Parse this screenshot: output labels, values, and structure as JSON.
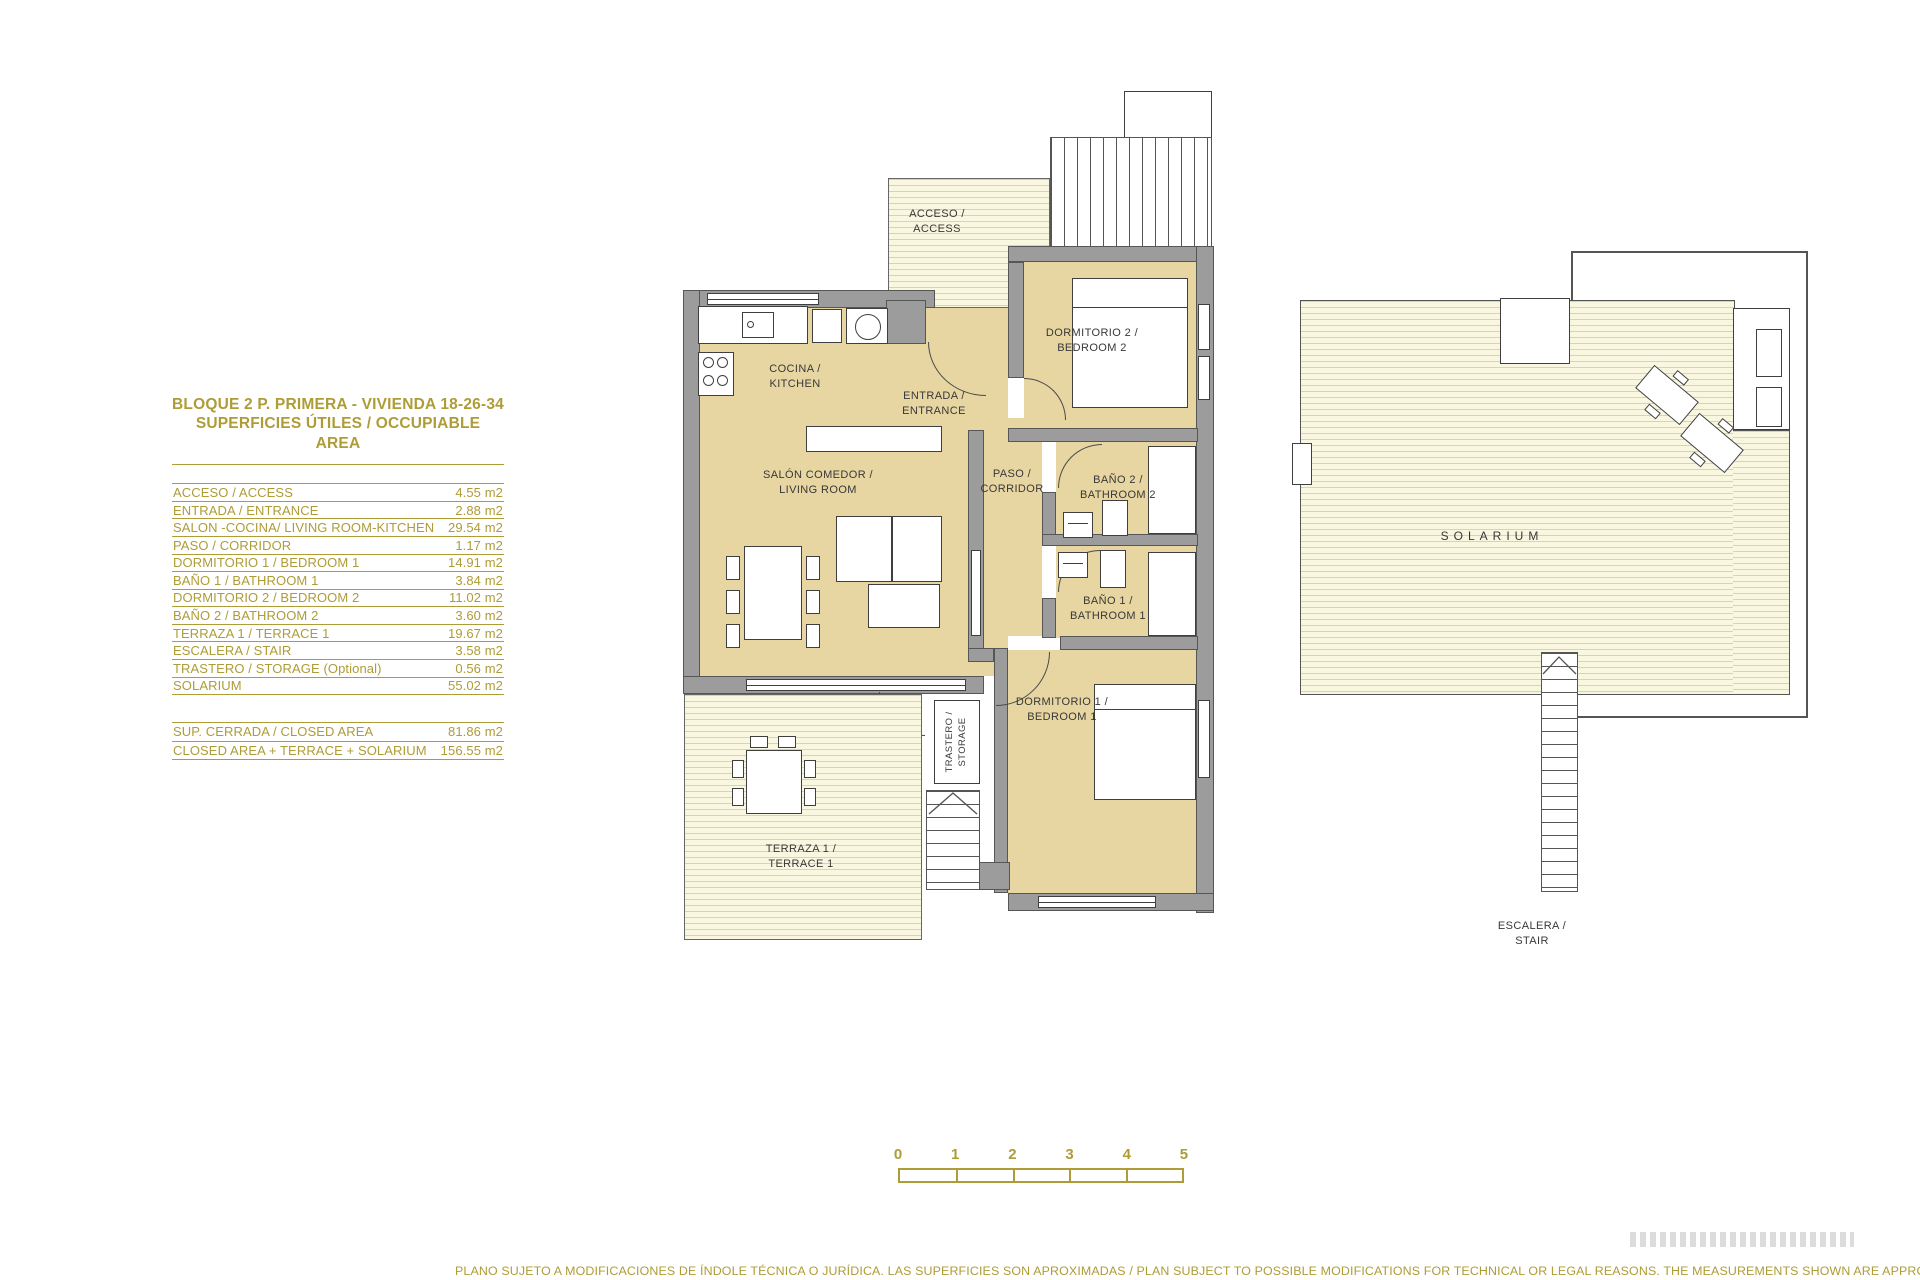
{
  "panel": {
    "title_line1": "BLOQUE 2  P. PRIMERA - VIVIENDA 18-26-34",
    "title_line2": "SUPERFICIES ÚTILES / OCCUPIABLE  AREA",
    "rows": [
      {
        "label": "ACCESO / ACCESS",
        "value": "4.55 m2"
      },
      {
        "label": "ENTRADA / ENTRANCE",
        "value": "2.88 m2"
      },
      {
        "label": "SALON -COCINA/ LIVING ROOM-KITCHEN",
        "value": "29.54 m2"
      },
      {
        "label": "PASO / CORRIDOR",
        "value": "1.17 m2"
      },
      {
        "label": "DORMITORIO 1 /  BEDROOM 1",
        "value": "14.91 m2"
      },
      {
        "label": "BAÑO 1 / BATHROOM 1",
        "value": "3.84 m2"
      },
      {
        "label": "DORMITORIO 2 / BEDROOM 2",
        "value": "11.02 m2"
      },
      {
        "label": "BAÑO 2 / BATHROOM 2",
        "value": "3.60 m2"
      },
      {
        "label": "TERRAZA 1 / TERRACE 1",
        "value": "19.67 m2"
      },
      {
        "label": "ESCALERA / STAIR",
        "value": "3.58 m2"
      },
      {
        "label": "TRASTERO / STORAGE (Optional)",
        "value": "0.56 m2"
      },
      {
        "label": "SOLARIUM",
        "value": "55.02 m2"
      }
    ],
    "summary_rows": [
      {
        "label": "SUP. CERRADA / CLOSED AREA",
        "value": "81.86 m2"
      },
      {
        "label": "CLOSED AREA + TERRACE + SOLARIUM",
        "value": "156.55 m2"
      }
    ]
  },
  "plan": {
    "labels": {
      "acceso": {
        "line1": "ACCESO /",
        "line2": "ACCESS"
      },
      "cocina": {
        "line1": "COCINA /",
        "line2": "KITCHEN"
      },
      "entrada": {
        "line1": "ENTRADA /",
        "line2": "ENTRANCE"
      },
      "salon": {
        "line1": "SALÓN COMEDOR /",
        "line2": "LIVING ROOM"
      },
      "paso": {
        "line1": "PASO /",
        "line2": "CORRIDOR"
      },
      "dormitorio2": {
        "line1": "DORMITORIO 2 /",
        "line2": "BEDROOM 2"
      },
      "bano2": {
        "line1": "BAÑO 2 /",
        "line2": "BATHROOM 2"
      },
      "bano1": {
        "line1": "BAÑO 1 /",
        "line2": "BATHROOM 1"
      },
      "dormitorio1": {
        "line1": "DORMITORIO 1 /",
        "line2": "BEDROOM 1"
      },
      "trastero": {
        "line1": "TRASTERO /",
        "line2": "STORAGE"
      },
      "terraza": {
        "line1": "TERRAZA 1 /",
        "line2": "TERRACE 1"
      },
      "solarium": {
        "line1": "SOLARIUM"
      },
      "escalera": {
        "line1": "ESCALERA /",
        "line2": "STAIR"
      }
    }
  },
  "scale_bar": {
    "ticks": [
      "0",
      "1",
      "2",
      "3",
      "4",
      "5"
    ]
  },
  "footer": {
    "disclaimer": "PLANO SUJETO A MODIFICACIONES DE ÍNDOLE TÉCNICA O JURÍDICA. LAS SUPERFICIES SON APROXIMADAS / PLAN SUBJECT TO POSSIBLE MODIFICATIONS FOR TECHNICAL OR LEGAL REASONS. THE MEASUREMENTS SHOWN ARE APPROXIMATE"
  },
  "colors": {
    "gold": "#ae9c36",
    "tan": "#e7d5a2",
    "hatch-bg": "#faf7e1",
    "hatch-line": "#dcd4a4",
    "wall": "#9c9c9c",
    "line": "#4a4a4a",
    "label": "#383838"
  }
}
